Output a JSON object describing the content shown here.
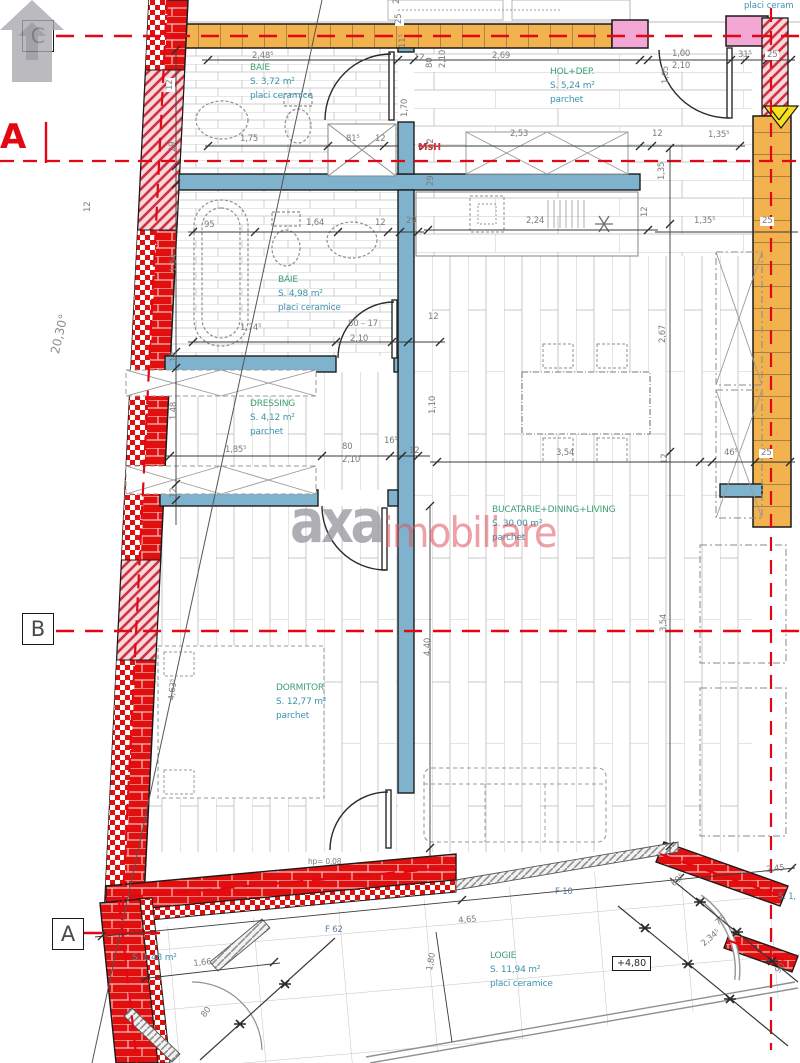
{
  "plan": {
    "angle_label": "20,30°",
    "section_label": "A",
    "msh_label": "MsH",
    "top_right_note": "placi ceram",
    "level_badge": "+4,80",
    "watermark": {
      "brand_gray": "axa",
      "brand_red": "imobiliare"
    },
    "colors": {
      "wall_red": "#e20f0f",
      "wall_orange": "#f2b24e",
      "wall_pink": "#f2a7d4",
      "wall_blue": "#7fb2cc",
      "axis_red": "#e30613",
      "room_name": "#3d9e74",
      "room_detail": "#3c93ad"
    }
  },
  "grid_markers": [
    {
      "label": "C",
      "x": 22,
      "y": 20
    },
    {
      "label": "B",
      "x": 22,
      "y": 613
    },
    {
      "label": "A",
      "x": 52,
      "y": 918
    }
  ],
  "rooms": [
    {
      "name": "BAIE",
      "area": "S. 3,72 m²",
      "finish": "placi ceramice",
      "x": 250,
      "y": 62
    },
    {
      "name": "HOL+DEP.",
      "area": "S. 5,24 m²",
      "finish": "parchet",
      "x": 550,
      "y": 66
    },
    {
      "name": "BAIE",
      "area": "S. 4,98 m²",
      "finish": "placi ceramice",
      "x": 278,
      "y": 274
    },
    {
      "name": "DRESSING",
      "area": "S. 4,12 m²",
      "finish": "parchet",
      "x": 250,
      "y": 398
    },
    {
      "name": "BUCATARIE+DINING+LIVING",
      "area": "S. 30,00 m²",
      "finish": "parchet",
      "x": 492,
      "y": 504
    },
    {
      "name": "DORMITOR",
      "area": "S. 12,77 m²",
      "finish": "parchet",
      "x": 276,
      "y": 682
    },
    {
      "name": "LOGIE",
      "area": "S. 11,94 m²",
      "finish": "placi ceramice",
      "x": 490,
      "y": 950
    },
    {
      "name": "",
      "area": "S. 1,48 m²",
      "finish": "",
      "x": 132,
      "y": 952
    }
  ],
  "dimensions": [
    {
      "t": "2,48⁵",
      "x": 252,
      "y": 52
    },
    {
      "t": "2,69",
      "x": 492,
      "y": 52
    },
    {
      "t": "1,00",
      "x": 672,
      "y": 50
    },
    {
      "t": "2,10",
      "x": 672,
      "y": 62
    },
    {
      "t": "31⁵",
      "x": 738,
      "y": 51
    },
    {
      "t": "25",
      "x": 765,
      "y": 51,
      "bg": 1
    },
    {
      "t": "29",
      "x": 393,
      "y": 4,
      "r": -90
    },
    {
      "t": "25",
      "x": 395,
      "y": 26,
      "r": -90,
      "bg": 1
    },
    {
      "t": "11⁵",
      "x": 399,
      "y": 48,
      "r": -90
    },
    {
      "t": "12",
      "x": 414,
      "y": 54
    },
    {
      "t": "80",
      "x": 426,
      "y": 68,
      "r": -90
    },
    {
      "t": "2,10",
      "x": 439,
      "y": 68,
      "r": -90
    },
    {
      "t": "1,05",
      "x": 662,
      "y": 84,
      "r": -90
    },
    {
      "t": "12",
      "x": 84,
      "y": 214,
      "r": -90,
      "bg": 1
    },
    {
      "t": "12",
      "x": 166,
      "y": 92,
      "r": -90,
      "bg": 1
    },
    {
      "t": "29",
      "x": 169,
      "y": 152,
      "r": -90
    },
    {
      "t": "1,75",
      "x": 240,
      "y": 135
    },
    {
      "t": "81⁵",
      "x": 346,
      "y": 135
    },
    {
      "t": "12",
      "x": 375,
      "y": 135
    },
    {
      "t": "2,53",
      "x": 510,
      "y": 130
    },
    {
      "t": "12",
      "x": 652,
      "y": 130
    },
    {
      "t": "1,35⁵",
      "x": 708,
      "y": 131
    },
    {
      "t": "1,70",
      "x": 401,
      "y": 117,
      "r": -90
    },
    {
      "t": "12",
      "x": 427,
      "y": 149,
      "r": -90
    },
    {
      "t": "29",
      "x": 427,
      "y": 186,
      "r": -90
    },
    {
      "t": "95",
      "x": 204,
      "y": 221
    },
    {
      "t": "1,64",
      "x": 306,
      "y": 219
    },
    {
      "t": "12",
      "x": 375,
      "y": 219
    },
    {
      "t": "29",
      "x": 406,
      "y": 217
    },
    {
      "t": "2,24",
      "x": 526,
      "y": 217
    },
    {
      "t": "12",
      "x": 641,
      "y": 217,
      "r": -90
    },
    {
      "t": "1,35",
      "x": 658,
      "y": 180,
      "r": -90
    },
    {
      "t": "1,35⁵",
      "x": 694,
      "y": 217
    },
    {
      "t": "25",
      "x": 760,
      "y": 217,
      "bg": 1
    },
    {
      "t": "1,64",
      "x": 170,
      "y": 272,
      "r": -90
    },
    {
      "t": "1,74⁵",
      "x": 240,
      "y": 324
    },
    {
      "t": "80 – 17",
      "x": 348,
      "y": 320
    },
    {
      "t": "2,10",
      "x": 350,
      "y": 335
    },
    {
      "t": "12",
      "x": 428,
      "y": 313
    },
    {
      "t": "2,67",
      "x": 659,
      "y": 343,
      "r": -90
    },
    {
      "t": "12",
      "x": 170,
      "y": 362,
      "r": -90
    },
    {
      "t": "1,48",
      "x": 170,
      "y": 420,
      "r": -90
    },
    {
      "t": "12",
      "x": 170,
      "y": 498,
      "r": -90
    },
    {
      "t": "1,85⁵",
      "x": 225,
      "y": 446
    },
    {
      "t": "80",
      "x": 342,
      "y": 443
    },
    {
      "t": "2,10",
      "x": 342,
      "y": 456
    },
    {
      "t": "16⁵",
      "x": 384,
      "y": 437
    },
    {
      "t": "12",
      "x": 409,
      "y": 447
    },
    {
      "t": "1,10",
      "x": 429,
      "y": 414,
      "r": -90
    },
    {
      "t": "3,54",
      "x": 556,
      "y": 449
    },
    {
      "t": "46⁵",
      "x": 724,
      "y": 449
    },
    {
      "t": "25",
      "x": 759,
      "y": 449,
      "bg": 1
    },
    {
      "t": "12",
      "x": 661,
      "y": 464,
      "r": -90
    },
    {
      "t": "3,54",
      "x": 660,
      "y": 632,
      "r": -90
    },
    {
      "t": "4,40",
      "x": 424,
      "y": 656,
      "r": -90
    },
    {
      "t": "4,63⁵",
      "x": 168,
      "y": 700,
      "r": -84
    },
    {
      "t": "hp= 0,08",
      "x": 308,
      "y": 858,
      "cls": "small"
    },
    {
      "t": "4,65",
      "x": 458,
      "y": 917,
      "r": -5
    },
    {
      "t": "F 62",
      "x": 325,
      "y": 926,
      "cls": "f"
    },
    {
      "t": "F 10",
      "x": 555,
      "y": 888,
      "cls": "f"
    },
    {
      "t": "1,66",
      "x": 193,
      "y": 960,
      "r": -6
    },
    {
      "t": "80",
      "x": 200,
      "y": 1014,
      "r": -52
    },
    {
      "t": "1,80",
      "x": 426,
      "y": 970,
      "r": -80
    },
    {
      "t": "2,45",
      "x": 766,
      "y": 866,
      "r": -6
    },
    {
      "t": "S. 1,",
      "x": 778,
      "y": 893,
      "cls": "teal"
    },
    {
      "t": "69⁵",
      "x": 670,
      "y": 882,
      "r": -40
    },
    {
      "t": "76",
      "x": 714,
      "y": 921,
      "r": -40
    },
    {
      "t": "2,34⁵",
      "x": 700,
      "y": 942,
      "r": -40
    },
    {
      "t": "90",
      "x": 774,
      "y": 970,
      "r": -52
    }
  ]
}
